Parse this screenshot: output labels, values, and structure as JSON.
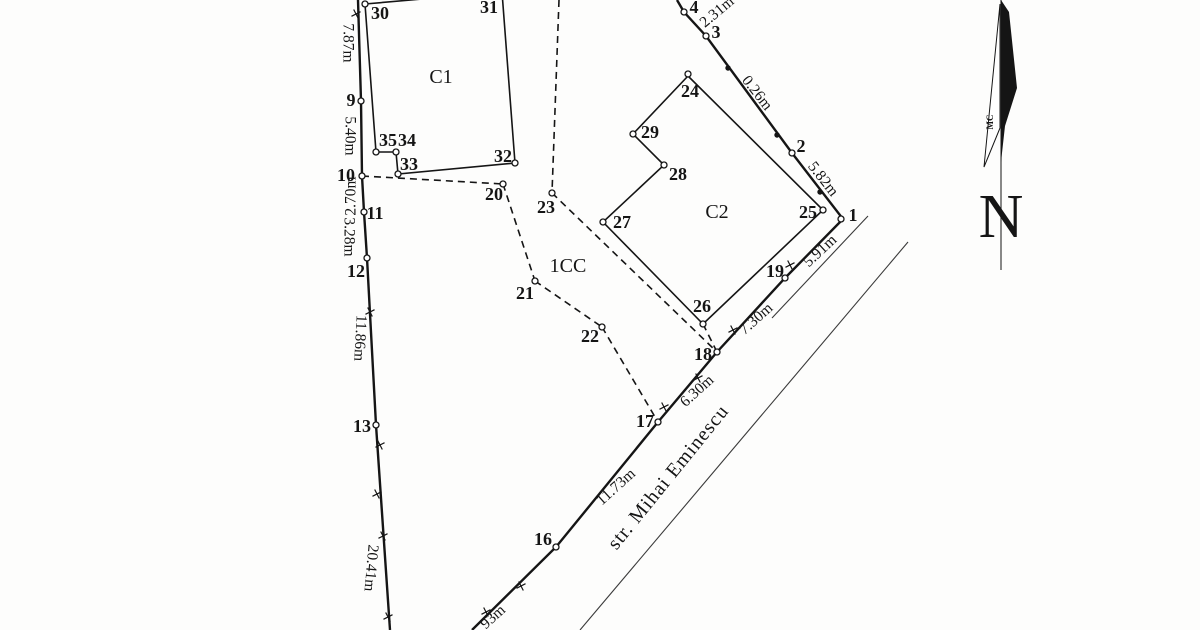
{
  "plan": {
    "street": {
      "label": "str. Mihai Eminescu"
    },
    "north": {
      "label": "N",
      "watermark": "MC"
    },
    "buildings": [
      {
        "id": "C1",
        "label": "C1"
      },
      {
        "id": "C2",
        "label": "C2"
      },
      {
        "id": "1CC",
        "label": "1CC"
      }
    ],
    "points": [
      {
        "n": "1",
        "marker": [
          841,
          219
        ],
        "label": [
          853,
          215
        ]
      },
      {
        "n": "2",
        "marker": [
          792,
          153
        ],
        "label": [
          801,
          146
        ]
      },
      {
        "n": "3",
        "marker": [
          706,
          36
        ],
        "label": [
          716,
          32
        ]
      },
      {
        "n": "4",
        "marker": [
          684,
          12
        ],
        "label": [
          694,
          7
        ]
      },
      {
        "n": "9",
        "marker": [
          361,
          101
        ],
        "label": [
          351,
          100
        ]
      },
      {
        "n": "10",
        "marker": [
          362,
          176
        ],
        "label": [
          346,
          175
        ]
      },
      {
        "n": "11",
        "marker": [
          364,
          212
        ],
        "label": [
          375,
          213
        ]
      },
      {
        "n": "12",
        "marker": [
          367,
          258
        ],
        "label": [
          356,
          271
        ]
      },
      {
        "n": "13",
        "marker": [
          376,
          425
        ],
        "label": [
          362,
          426
        ]
      },
      {
        "n": "16",
        "marker": [
          556,
          547
        ],
        "label": [
          543,
          539
        ]
      },
      {
        "n": "17",
        "marker": [
          658,
          422
        ],
        "label": [
          645,
          421
        ]
      },
      {
        "n": "18",
        "marker": [
          717,
          352
        ],
        "label": [
          703,
          354
        ]
      },
      {
        "n": "19",
        "marker": [
          785,
          278
        ],
        "label": [
          775,
          271
        ]
      },
      {
        "n": "20",
        "marker": [
          503,
          184
        ],
        "label": [
          494,
          194
        ]
      },
      {
        "n": "21",
        "marker": [
          535,
          281
        ],
        "label": [
          525,
          293
        ]
      },
      {
        "n": "22",
        "marker": [
          602,
          327
        ],
        "label": [
          590,
          336
        ]
      },
      {
        "n": "23",
        "marker": [
          552,
          193
        ],
        "label": [
          546,
          207
        ]
      },
      {
        "n": "24",
        "marker": [
          688,
          74
        ],
        "label": [
          690,
          91
        ]
      },
      {
        "n": "25",
        "marker": [
          823,
          210
        ],
        "label": [
          808,
          212
        ]
      },
      {
        "n": "26",
        "marker": [
          703,
          324
        ],
        "label": [
          702,
          306
        ]
      },
      {
        "n": "27",
        "marker": [
          603,
          222
        ],
        "label": [
          622,
          222
        ]
      },
      {
        "n": "28",
        "marker": [
          664,
          165
        ],
        "label": [
          678,
          174
        ]
      },
      {
        "n": "29",
        "marker": [
          633,
          134
        ],
        "label": [
          650,
          132
        ]
      },
      {
        "n": "30",
        "marker": [
          365,
          4
        ],
        "label": [
          380,
          13
        ]
      },
      {
        "n": "31",
        "marker": null,
        "label": [
          489,
          7
        ]
      },
      {
        "n": "32",
        "marker": [
          515,
          163
        ],
        "label": [
          503,
          156
        ]
      },
      {
        "n": "33",
        "marker": [
          398,
          174
        ],
        "label": [
          409,
          164
        ]
      },
      {
        "n": "34",
        "marker": [
          396,
          152
        ],
        "label": [
          407,
          140
        ]
      },
      {
        "n": "35",
        "marker": [
          376,
          152
        ],
        "label": [
          388,
          140
        ]
      }
    ],
    "dimensions": [
      {
        "text": "7.87m",
        "x": 348,
        "y": 43,
        "rot": 90
      },
      {
        "text": "5.40m",
        "x": 350,
        "y": 136,
        "rot": 90
      },
      {
        "text": "2.70m",
        "x": 351,
        "y": 196,
        "rot": -90
      },
      {
        "text": "3.28m",
        "x": 349,
        "y": 237,
        "rot": 90
      },
      {
        "text": "11.86m",
        "x": 360,
        "y": 338,
        "rot": 93
      },
      {
        "text": "20.41m",
        "x": 371,
        "y": 568,
        "rot": 95
      },
      {
        "text": "2.31m",
        "x": 717,
        "y": 12,
        "rot": -40
      },
      {
        "text": "0.26m",
        "x": 757,
        "y": 93,
        "rot": 52
      },
      {
        "text": "5.82m",
        "x": 823,
        "y": 179,
        "rot": 52
      },
      {
        "text": "5.91m",
        "x": 820,
        "y": 251,
        "rot": -43
      },
      {
        "text": "7.30m",
        "x": 756,
        "y": 319,
        "rot": -42
      },
      {
        "text": "6.30m",
        "x": 697,
        "y": 391,
        "rot": -42
      },
      {
        "text": "11.73m",
        "x": 616,
        "y": 487,
        "rot": -42
      },
      {
        "text": "93m",
        "x": 493,
        "y": 617,
        "rot": -42
      }
    ],
    "geometry": {
      "thick": [
        [
          [
            358,
            0
          ],
          [
            361,
            101
          ],
          [
            362,
            176
          ],
          [
            364,
            212
          ],
          [
            367,
            258
          ],
          [
            376,
            425
          ],
          [
            390,
            630
          ]
        ],
        [
          [
            677,
            0
          ],
          [
            684,
            12
          ],
          [
            706,
            36
          ],
          [
            792,
            153
          ],
          [
            843,
            219
          ],
          [
            785,
            278
          ],
          [
            717,
            352
          ],
          [
            658,
            422
          ],
          [
            556,
            547
          ],
          [
            472,
            630
          ]
        ]
      ],
      "thin": [
        [
          [
            868,
            216
          ],
          [
            772,
            318
          ]
        ],
        [
          [
            908,
            242
          ],
          [
            580,
            630
          ]
        ]
      ],
      "buildings": [
        [
          [
            365,
            4
          ],
          [
            502,
            -8
          ],
          [
            515,
            163
          ],
          [
            398,
            174
          ],
          [
            396,
            152
          ],
          [
            376,
            152
          ]
        ],
        [
          [
            688,
            76
          ],
          [
            823,
            210
          ],
          [
            703,
            324
          ],
          [
            603,
            222
          ],
          [
            664,
            165
          ],
          [
            633,
            134
          ]
        ]
      ],
      "dashed": [
        [
          [
            559,
            0
          ],
          [
            552,
            193
          ]
        ],
        [
          [
            362,
            176
          ],
          [
            503,
            184
          ]
        ],
        [
          [
            503,
            184
          ],
          [
            535,
            281
          ]
        ],
        [
          [
            535,
            281
          ],
          [
            602,
            327
          ]
        ],
        [
          [
            602,
            327
          ],
          [
            658,
            422
          ]
        ],
        [
          [
            552,
            193
          ],
          [
            717,
            352
          ]
        ],
        [
          [
            703,
            324
          ],
          [
            717,
            352
          ]
        ]
      ],
      "filled_markers": [
        [
          728,
          68
        ],
        [
          777,
          135
        ],
        [
          820,
          192
        ]
      ],
      "ticks": [
        [
          356,
          14
        ],
        [
          370,
          312
        ],
        [
          380,
          445
        ],
        [
          377,
          494
        ],
        [
          383,
          536
        ],
        [
          388,
          617
        ],
        [
          790,
          265
        ],
        [
          733,
          330
        ],
        [
          698,
          378
        ],
        [
          664,
          407
        ],
        [
          521,
          586
        ],
        [
          486,
          612
        ]
      ],
      "north": {
        "shaft": [
          [
            1001,
            0
          ],
          [
            1001,
            270
          ]
        ],
        "black_path": "M1001,0 L1009,12 L1017,88 L1005,126 L1001,162 Z",
        "white_path": "M1000,4 L984,167 L1000,128 Z"
      },
      "ink": "#151515"
    }
  }
}
